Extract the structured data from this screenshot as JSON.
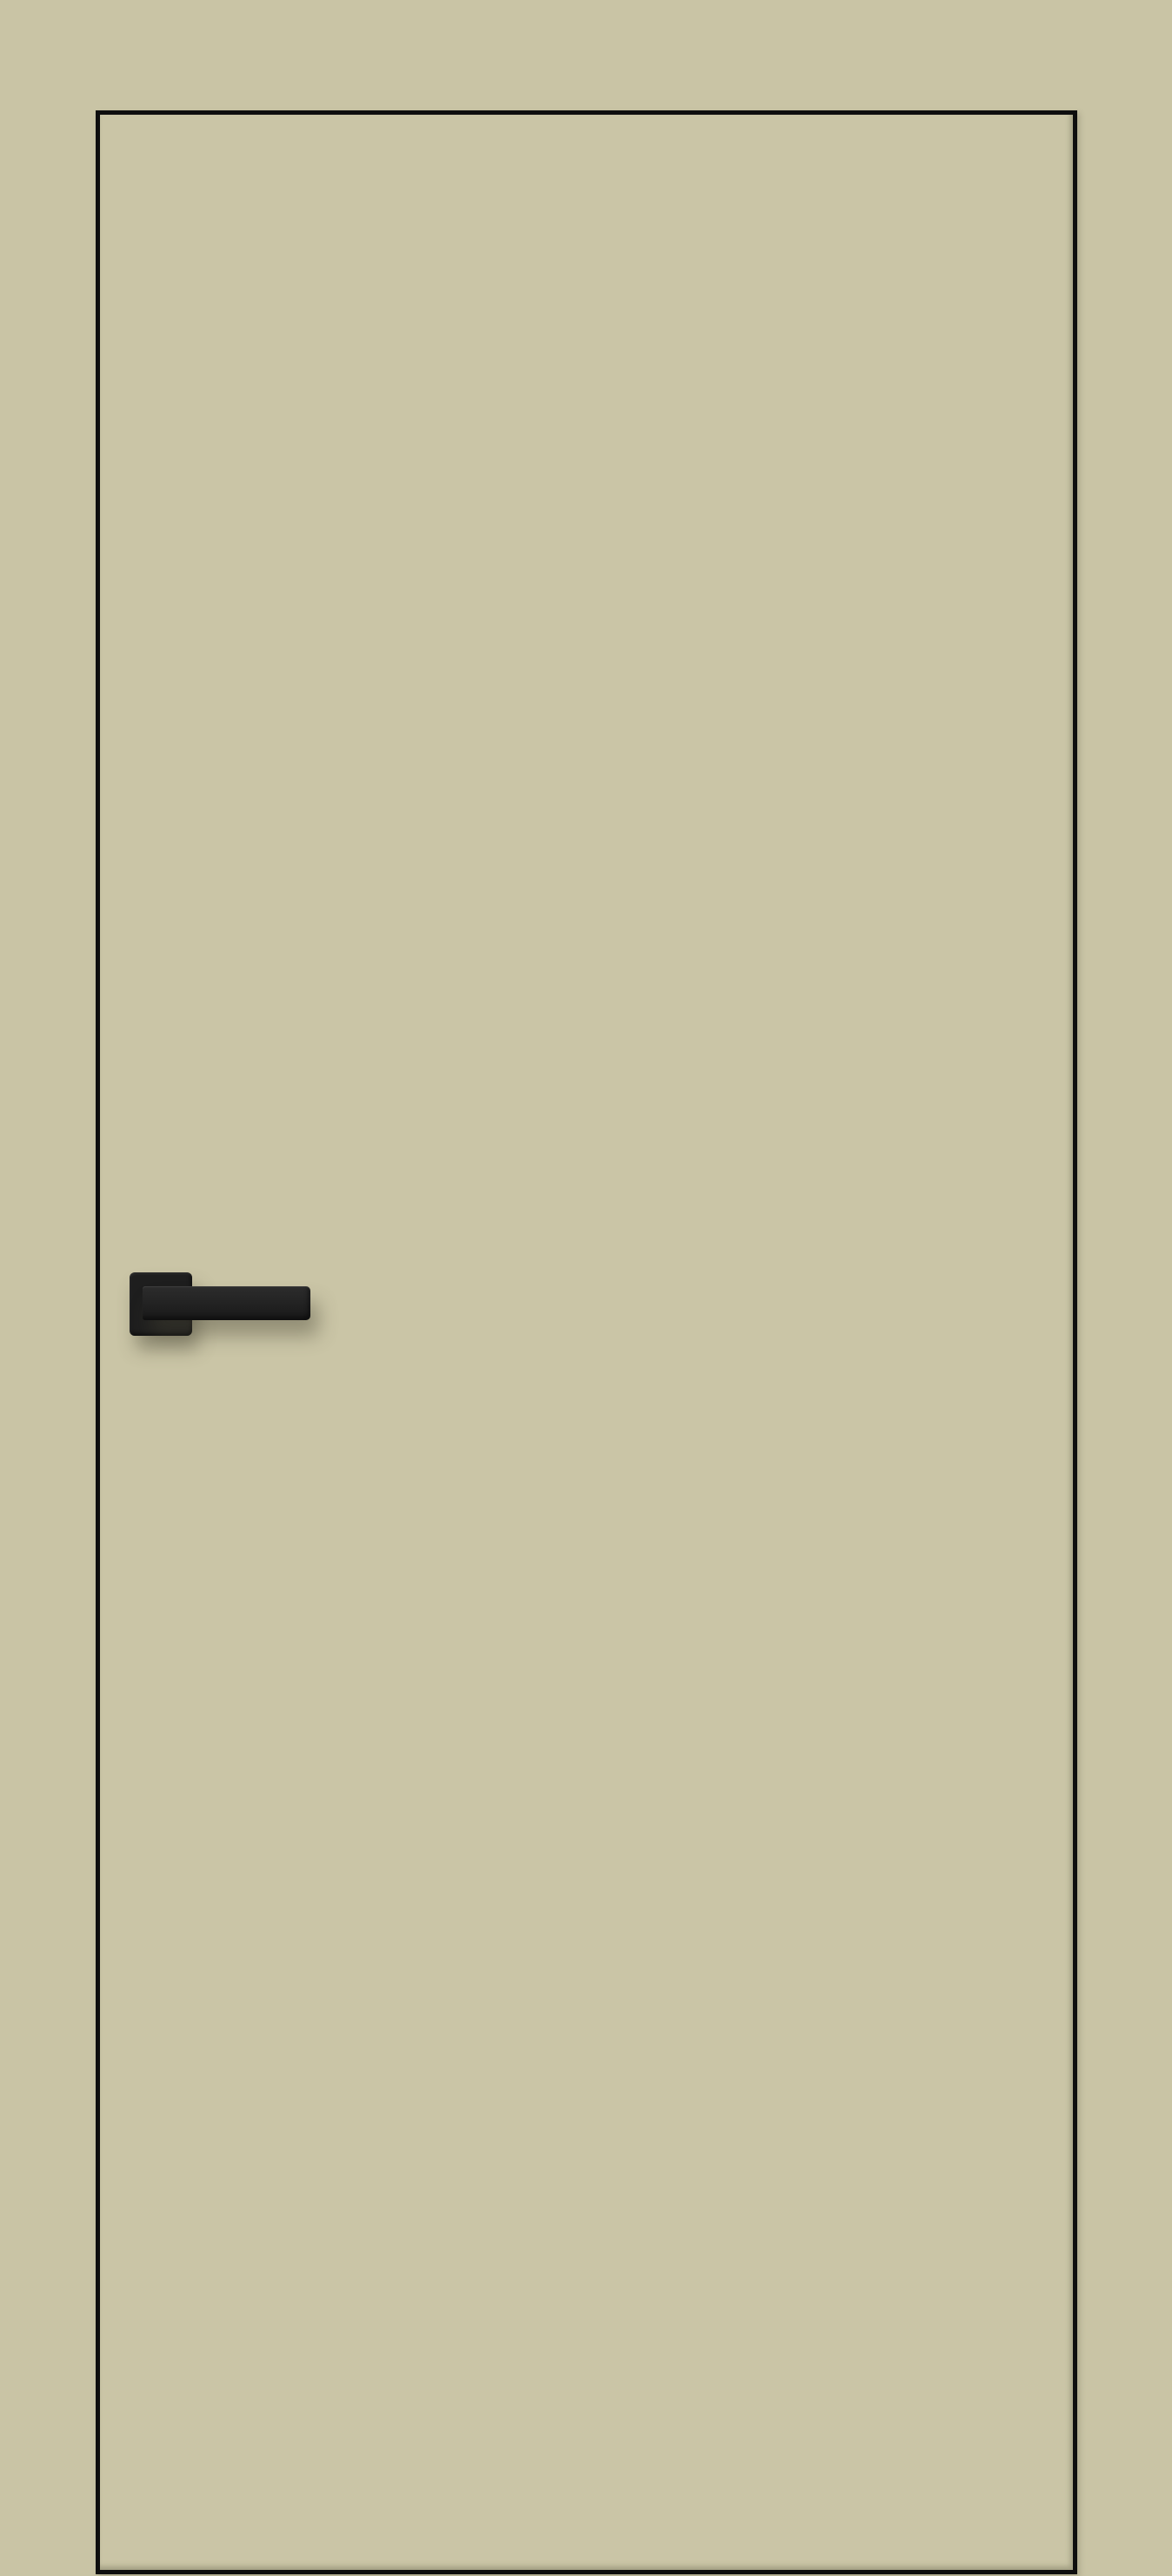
{
  "scene": {
    "type": "product-render",
    "subject": "flush-interior-door",
    "handle_side": "left",
    "handle_style": "square-rosette-lever"
  },
  "colors": {
    "background": "#c9c4a5",
    "door_leaf": "#cac5a6",
    "door_outline": "#0e0e0e",
    "handle": "#1e1e1e",
    "handle_highlight": "#2c2c2c",
    "shadow": "rgba(72, 70, 52, 0.42)"
  }
}
